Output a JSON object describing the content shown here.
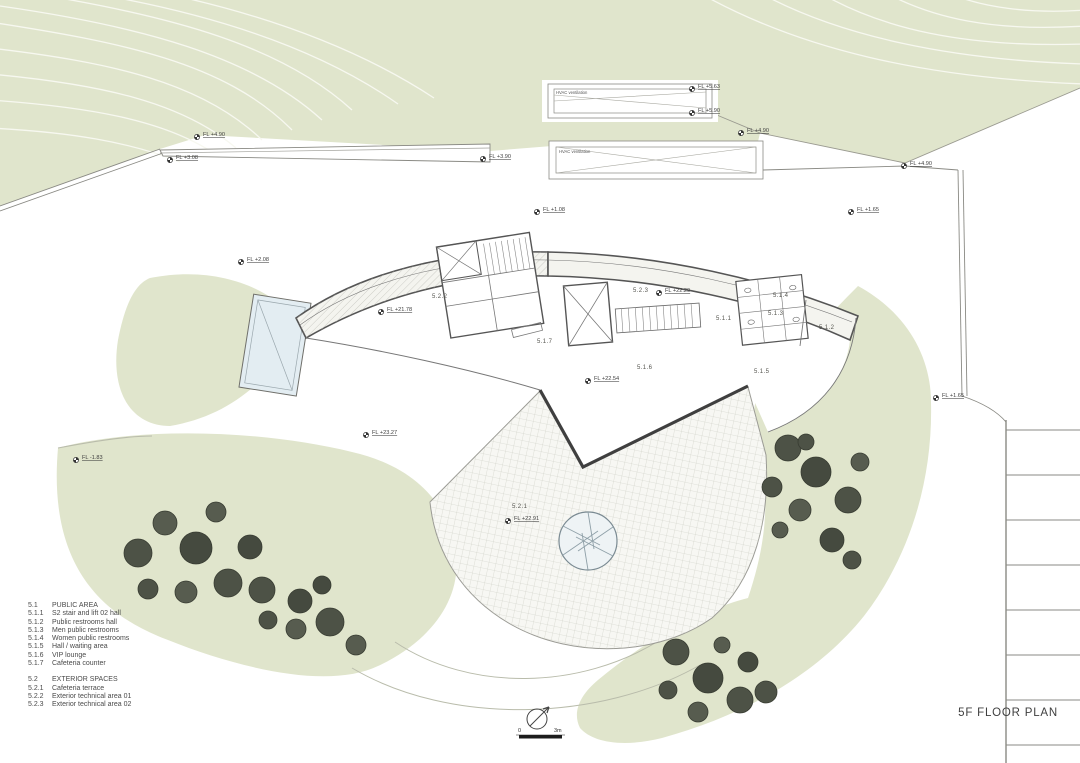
{
  "title": "5F FLOOR PLAN",
  "legend": {
    "sections": [
      {
        "code": "5.1",
        "label": "PUBLIC AREA",
        "items": [
          {
            "code": "5.1.1",
            "label": "S2 stair and lift 02 hall"
          },
          {
            "code": "5.1.2",
            "label": "Public restrooms hall"
          },
          {
            "code": "5.1.3",
            "label": "Men public restrooms"
          },
          {
            "code": "5.1.4",
            "label": "Women public restrooms"
          },
          {
            "code": "5.1.5",
            "label": "Hall / waiting area"
          },
          {
            "code": "5.1.6",
            "label": "VIP lounge"
          },
          {
            "code": "5.1.7",
            "label": "Cafeteria counter"
          }
        ]
      },
      {
        "code": "5.2",
        "label": "EXTERIOR SPACES",
        "items": [
          {
            "code": "5.2.1",
            "label": "Cafeteria terrace"
          },
          {
            "code": "5.2.2",
            "label": "Exterior technical area 01"
          },
          {
            "code": "5.2.3",
            "label": "Exterior technical area 02"
          }
        ]
      }
    ]
  },
  "levels": [
    {
      "text": "FL +5.63"
    },
    {
      "text": "FL +5.90"
    },
    {
      "text": "FL +4.90"
    },
    {
      "text": "FL +3.08"
    },
    {
      "text": "FL +3.90"
    },
    {
      "text": "FL +4.90"
    },
    {
      "text": "FL +4.90"
    },
    {
      "text": "FL +1.08"
    },
    {
      "text": "FL +1.65"
    },
    {
      "text": "FL +2.08"
    },
    {
      "text": "FL +21.78"
    },
    {
      "text": "FL +22.29"
    },
    {
      "text": "FL +22.54"
    },
    {
      "text": "FL +1.65"
    },
    {
      "text": "FL +23.27"
    },
    {
      "text": "FL -1.83"
    },
    {
      "text": "FL +22.91"
    }
  ],
  "rooms": [
    {
      "code": "5.2.2"
    },
    {
      "code": "5.2.3"
    },
    {
      "code": "5.1.7"
    },
    {
      "code": "5.1.6"
    },
    {
      "code": "5.1.5"
    },
    {
      "code": "5.1.2"
    },
    {
      "code": "5.1.1"
    },
    {
      "code": "5.1.3"
    },
    {
      "code": "5.1.4"
    },
    {
      "code": "5.2.1"
    }
  ],
  "hvac": [
    {
      "label": "HVAC ventilation"
    },
    {
      "label": "HVAC ventilation"
    }
  ],
  "scale_bar": {
    "zero": "0",
    "max": "3m"
  },
  "colors": {
    "terrain_green": "#e0e5cc",
    "contour_line": "#f7f8f0",
    "tree_dark": "#4d5246",
    "wall_gray": "#555555",
    "terrace_grid": "#c8cabf",
    "skylight_blue": "#e3edf2"
  }
}
